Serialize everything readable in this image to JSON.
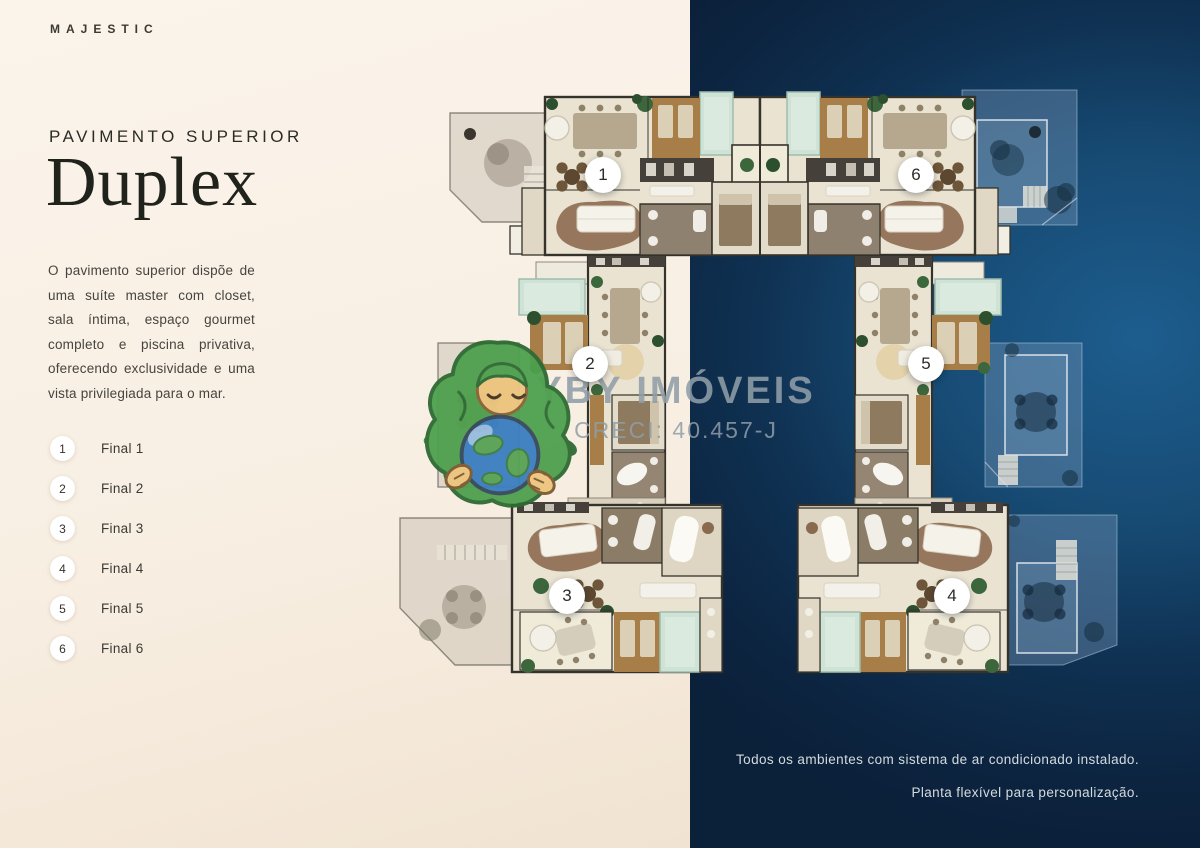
{
  "brand": "MAJESTIC",
  "sidebar": {
    "heading": "PAVIMENTO SUPERIOR",
    "title": "Duplex",
    "description": "O pavimento superior dispõe de uma suíte master com closet, sala íntima, espaço gourmet completo e piscina privativa, oferecendo exclusividade e uma vista privilegiada para o mar.",
    "legend": [
      {
        "number": "1",
        "label": "Final 1"
      },
      {
        "number": "2",
        "label": "Final 2"
      },
      {
        "number": "3",
        "label": "Final 3"
      },
      {
        "number": "4",
        "label": "Final 4"
      },
      {
        "number": "5",
        "label": "Final 5"
      },
      {
        "number": "6",
        "label": "Final 6"
      }
    ]
  },
  "plan": {
    "badges": [
      {
        "number": "1"
      },
      {
        "number": "2"
      },
      {
        "number": "3"
      },
      {
        "number": "4"
      },
      {
        "number": "5"
      },
      {
        "number": "6"
      }
    ]
  },
  "watermark": {
    "company": "YBY IMÓVEIS",
    "creci": "CRECI: 40.457-J",
    "mascot_icon": "earth-mother-mascot"
  },
  "footer": {
    "line1": "Todos os ambientes com sistema de ar condicionado instalado.",
    "line2": "Planta flexível para personalização."
  },
  "colors": {
    "cream_bg": "#f8efe3",
    "navy_bg": "#0f2a40",
    "title_text": "#20221c",
    "pool": "#cfe2d6",
    "deck_wood": "#a87e48",
    "badge_bg": "#ffffff",
    "watermark_text": "#8f9da7"
  }
}
